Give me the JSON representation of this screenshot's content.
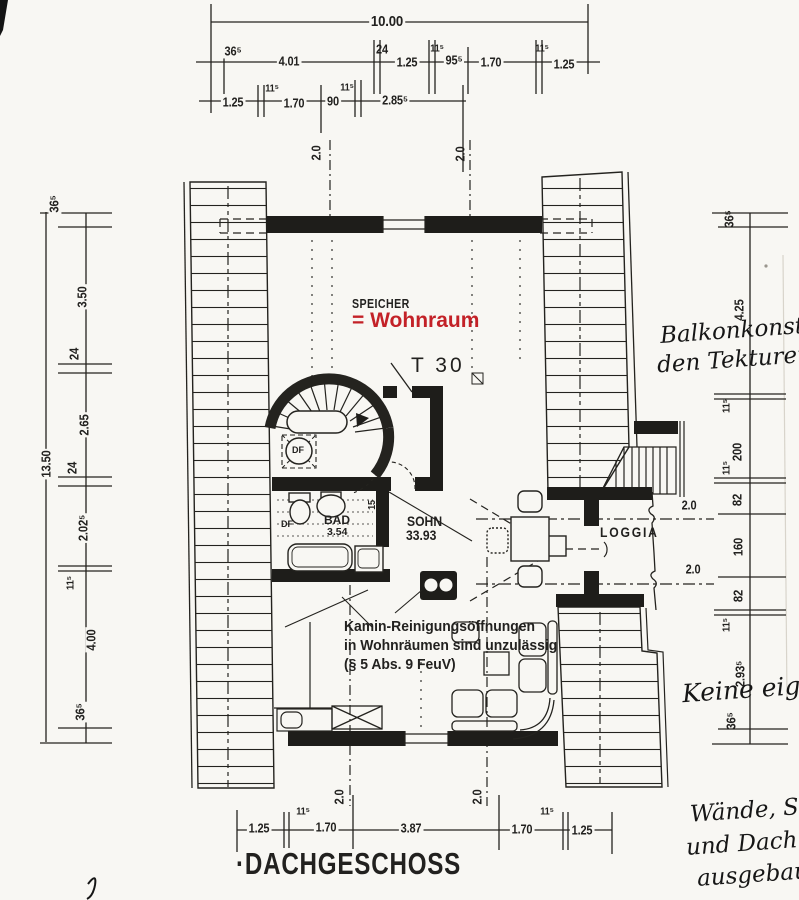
{
  "title": "·DACHGESCHOSS",
  "colors": {
    "ink": "#22211f",
    "red": "#c32127",
    "paper": "#f8f7f3"
  },
  "plan": {
    "speicher_label": "SPEICHER",
    "speicher_note": "= Wohnraum",
    "door_label": "T 30",
    "roof_window_label": "DF",
    "bad_roof_window_label": "DF",
    "bad_name": "BAD",
    "bad_area": "3.54",
    "sohn_name": "SOHN",
    "sohn_area": "33.93",
    "loggia_name": "LOGGIA",
    "wall_thickness_label": "15"
  },
  "dimensions": {
    "top_total": "10.00",
    "top_row2": [
      "36⁵",
      "4.01",
      "24",
      "1.25",
      "11⁵",
      "95⁵",
      "1.70",
      "11⁵",
      "1.25"
    ],
    "top_row3": [
      "1.25",
      "11⁵",
      "1.70",
      "90",
      "11⁵",
      "2.85⁵"
    ],
    "left_total": "13.50",
    "left_chain": [
      "36⁵",
      "3.50",
      "24",
      "2.65",
      "24",
      "2.02⁵",
      "11⁵",
      "4.00",
      "36⁵"
    ],
    "right_chain": [
      "36⁵",
      "4.25",
      "11⁵",
      "200",
      "11⁵",
      "82",
      "160",
      "82",
      "11⁵",
      "2.93⁵",
      "36⁵"
    ],
    "bottom_chain": [
      "1.25",
      "11⁵",
      "1.70",
      "3.87",
      "1.70",
      "11⁵",
      "1.25"
    ],
    "height_mark": "2.0"
  },
  "annotation": {
    "line1": "Kamin-Reinigungsöffnungen",
    "line2": "in Wohnräumen sind unzulässig",
    "line3": "(§ 5 Abs. 9 FeuV)"
  },
  "handwriting": {
    "right_top_line1": "Balkonkonst",
    "right_top_line2": "den Tekturen",
    "right_mid": "Keine eigen",
    "bottom_line1": "Wände, S",
    "bottom_line2": "und Dach",
    "bottom_line3": "ausgebau"
  }
}
